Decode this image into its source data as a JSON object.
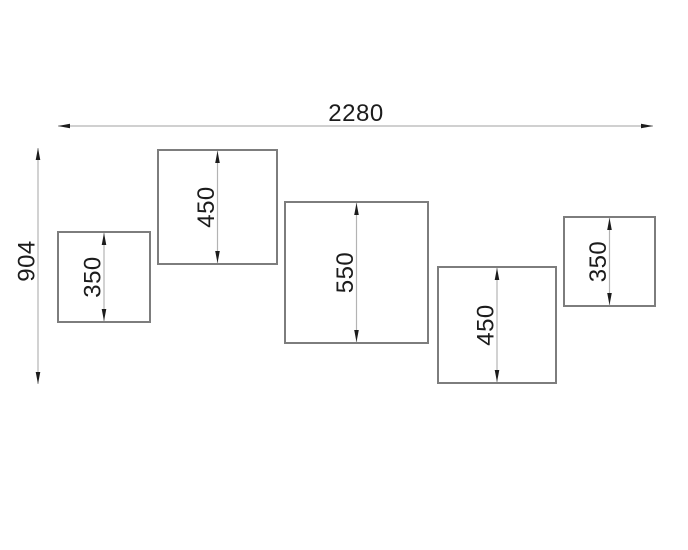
{
  "drawing": {
    "description": "CAD elevation drawing of five staggered square wall panels with height dimensions and overall width/height dimensions",
    "colors": {
      "background": "#ffffff",
      "box_stroke": "#7d7d7d",
      "dim_line": "#b3b3b3",
      "arrow": "#1c1c1c",
      "text": "#1c1c1c"
    },
    "font_size_px": 24,
    "overall_width_dim": {
      "label": "2280",
      "line": {
        "x1": 58,
        "x2": 653,
        "y": 126
      },
      "label_pos": {
        "x": 356,
        "y": 121
      }
    },
    "overall_height_dim": {
      "label": "904",
      "line": {
        "x": 38,
        "y1": 148,
        "y2": 384
      },
      "label_pos": {
        "x": 26,
        "y": 261
      }
    },
    "boxes": [
      {
        "label": "350",
        "x": 58,
        "y": 232,
        "w": 92,
        "h": 90
      },
      {
        "label": "450",
        "x": 158,
        "y": 150,
        "w": 119,
        "h": 114
      },
      {
        "label": "550",
        "x": 285,
        "y": 202,
        "w": 143,
        "h": 141
      },
      {
        "label": "450",
        "x": 438,
        "y": 267,
        "w": 118,
        "h": 116
      },
      {
        "label": "350",
        "x": 564,
        "y": 217,
        "w": 91,
        "h": 89
      }
    ]
  }
}
